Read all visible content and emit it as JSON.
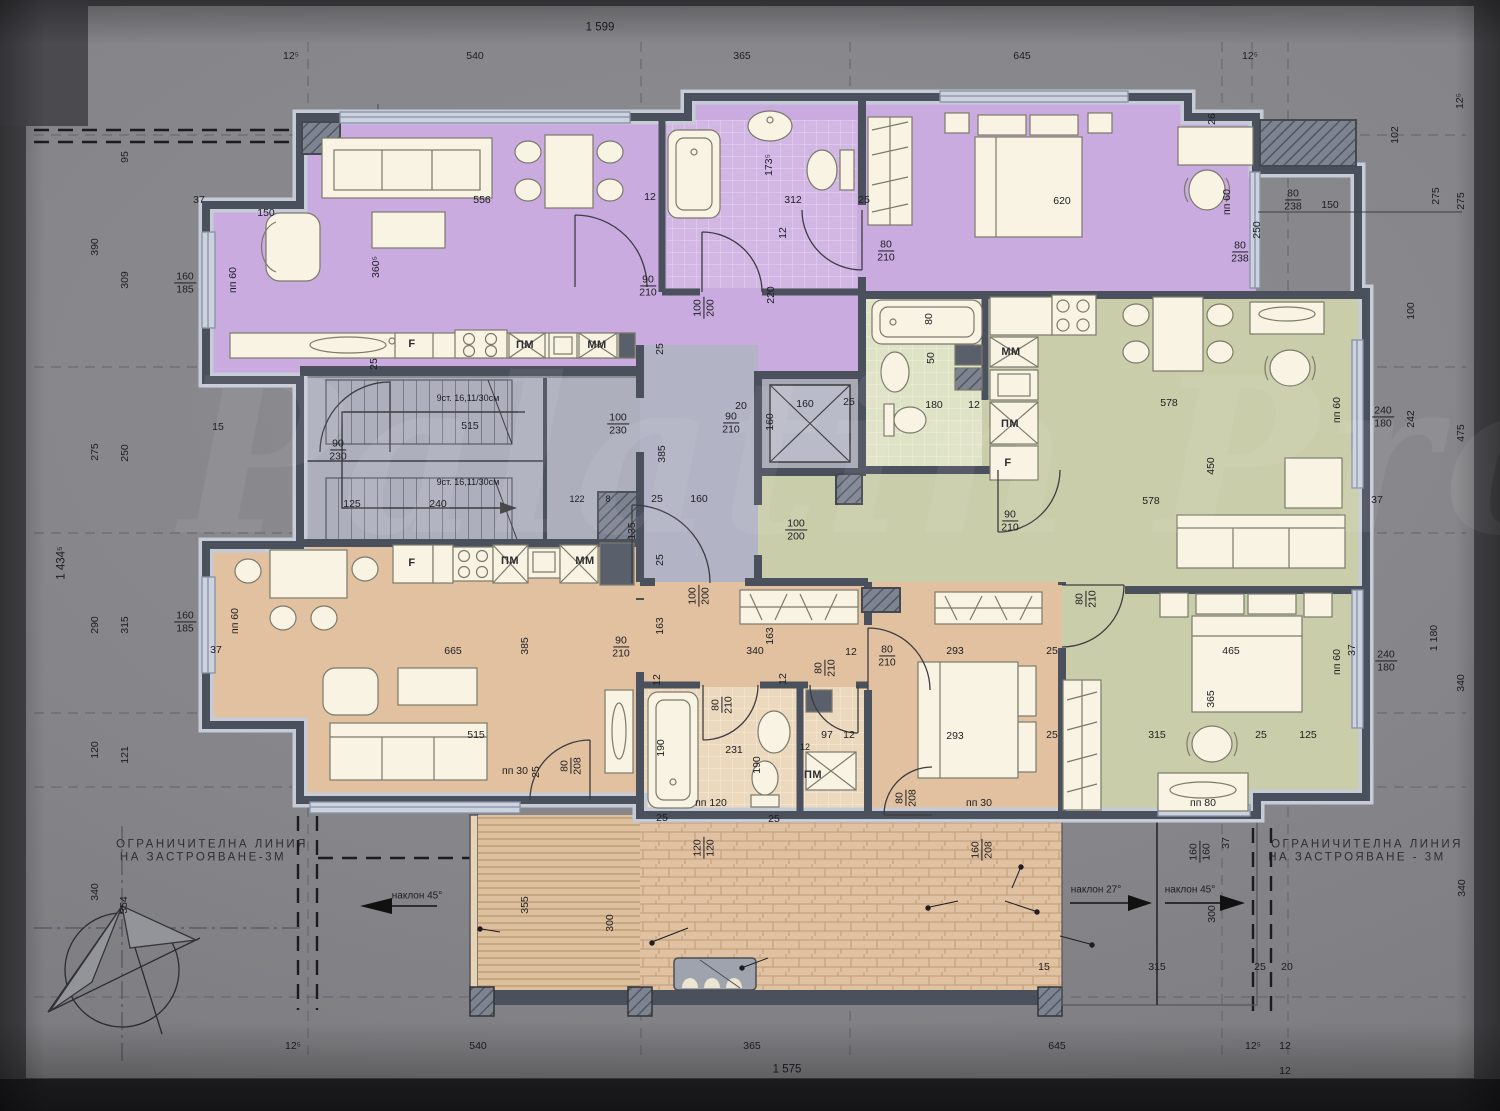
{
  "overall": {
    "top": "1 599",
    "bottom": "1 575",
    "left": "1 434⁵"
  },
  "apartments": [
    {
      "name": "Ап. 13",
      "area": "62,80м2",
      "color": "#c9abdf"
    },
    {
      "name": "Ап. 14",
      "area": "60,72м2",
      "color": "#c9cda9"
    },
    {
      "name": "Ап. 15",
      "area": "79,56м2",
      "color": "#e2c1a0"
    }
  ],
  "rooms": {
    "stair_area": "12,87 м2",
    "hall_area": "6,26 м2",
    "stair_note": "с.тр.",
    "elec_note": "ел."
  },
  "terrace": {
    "title": "покрив тераса",
    "area": "24,38 м²",
    "notes": {
      "pergola": "пергола-по детайл",
      "curb1": "ст.бет. борд - шир. 15см",
      "curb2": "височина 120см",
      "shaft1": "инсталационна",
      "shaft2": "шахта- борд ст. бет. 15см"
    }
  },
  "boundary": {
    "line1": "ОГРАНИЧИТЕЛНА  ЛИНИЯ",
    "line2": "НА ЗАСТРОЯВАНЕ-3М",
    "line2_right": "НА ЗАСТРОЯВАНЕ - 3М"
  },
  "slopes": {
    "s45": "наклон 45°",
    "s27": "наклон 27°"
  },
  "watermark": "Palatin Pro",
  "colors": {
    "wall": "#4b505d",
    "window": "#ccd3df",
    "deck": "#dcc09e",
    "brick": "#e0c2a2",
    "core_gray": "#aeafbd"
  },
  "dims": [
    {
      "t": "12⁵",
      "x": 291,
      "y": 57
    },
    {
      "t": "540",
      "x": 475,
      "y": 57
    },
    {
      "t": "365",
      "x": 742,
      "y": 57
    },
    {
      "t": "645",
      "x": 1022,
      "y": 57
    },
    {
      "t": "12⁵",
      "x": 1250,
      "y": 57
    },
    {
      "t": "12⁵",
      "x": 293,
      "y": 1047
    },
    {
      "t": "540",
      "x": 478,
      "y": 1047
    },
    {
      "t": "365",
      "x": 752,
      "y": 1047
    },
    {
      "t": "645",
      "x": 1057,
      "y": 1047
    },
    {
      "t": "12⁵",
      "x": 1253,
      "y": 1047
    },
    {
      "t": "12",
      "x": 1285,
      "y": 1047
    },
    {
      "t": "12",
      "x": 1285,
      "y": 1072
    },
    {
      "t": "390",
      "x": 96,
      "y": 247,
      "r": 1
    },
    {
      "t": "95",
      "x": 126,
      "y": 157,
      "r": 1
    },
    {
      "t": "309",
      "x": 126,
      "y": 280,
      "r": 1
    },
    {
      "t": "275",
      "x": 96,
      "y": 452,
      "r": 1
    },
    {
      "t": "250",
      "x": 126,
      "y": 453,
      "r": 1
    },
    {
      "t": "290",
      "x": 96,
      "y": 625,
      "r": 1
    },
    {
      "t": "315",
      "x": 126,
      "y": 625,
      "r": 1
    },
    {
      "t": "120",
      "x": 96,
      "y": 750,
      "r": 1
    },
    {
      "t": "121",
      "x": 126,
      "y": 755,
      "r": 1
    },
    {
      "t": "340",
      "x": 96,
      "y": 892,
      "r": 1
    },
    {
      "t": "354",
      "x": 125,
      "y": 905,
      "r": 1
    },
    {
      "t": "12⁵",
      "x": 1461,
      "y": 101,
      "r": 1
    },
    {
      "t": "102",
      "x": 1396,
      "y": 135,
      "r": 1
    },
    {
      "t": "275",
      "x": 1437,
      "y": 196,
      "r": 1
    },
    {
      "t": "275",
      "x": 1462,
      "y": 201,
      "r": 1
    },
    {
      "t": "100",
      "x": 1412,
      "y": 311,
      "r": 1
    },
    {
      "t": "242",
      "x": 1412,
      "y": 419,
      "r": 1
    },
    {
      "t": "475",
      "x": 1462,
      "y": 433,
      "r": 1
    },
    {
      "t": "1 180",
      "x": 1435,
      "y": 638,
      "r": 1
    },
    {
      "t": "340",
      "x": 1462,
      "y": 683,
      "r": 1
    },
    {
      "t": "340",
      "x": 1463,
      "y": 888,
      "r": 1
    },
    {
      "t": "37",
      "x": 1377,
      "y": 501
    },
    {
      "t": "37",
      "x": 1353,
      "y": 650,
      "r": 1
    },
    {
      "t": "160|185",
      "x": 185,
      "y": 283,
      "k": "f"
    },
    {
      "t": "160|185",
      "x": 185,
      "y": 622,
      "k": "f"
    },
    {
      "t": "240|180",
      "x": 1383,
      "y": 417,
      "k": "f"
    },
    {
      "t": "240|180",
      "x": 1386,
      "y": 661,
      "k": "f"
    },
    {
      "t": "80|238",
      "x": 1293,
      "y": 200,
      "k": "f"
    },
    {
      "t": "80|238",
      "x": 1240,
      "y": 252,
      "k": "f"
    },
    {
      "t": "80|210",
      "x": 886,
      "y": 251,
      "k": "f"
    },
    {
      "t": "90|210",
      "x": 731,
      "y": 423,
      "k": "f"
    },
    {
      "t": "90|210",
      "x": 648,
      "y": 286,
      "k": "f"
    },
    {
      "t": "90|210",
      "x": 1010,
      "y": 521,
      "k": "f"
    },
    {
      "t": "100|200",
      "x": 796,
      "y": 530,
      "k": "f"
    },
    {
      "t": "100|230",
      "x": 618,
      "y": 424,
      "k": "f"
    },
    {
      "t": "90|230",
      "x": 338,
      "y": 450,
      "k": "f"
    },
    {
      "t": "100|200",
      "x": 704,
      "y": 308,
      "k": "f",
      "r": 1
    },
    {
      "t": "80|210",
      "x": 1086,
      "y": 599,
      "k": "f",
      "r": 1
    },
    {
      "t": "80|210",
      "x": 825,
      "y": 668,
      "k": "f",
      "r": 1
    },
    {
      "t": "80|210",
      "x": 722,
      "y": 705,
      "k": "f",
      "r": 1
    },
    {
      "t": "100|200",
      "x": 699,
      "y": 596,
      "k": "f",
      "r": 1
    },
    {
      "t": "80|208",
      "x": 571,
      "y": 766,
      "k": "f",
      "r": 1
    },
    {
      "t": "80|208",
      "x": 906,
      "y": 798,
      "k": "f",
      "r": 1
    },
    {
      "t": "160|208",
      "x": 982,
      "y": 850,
      "k": "f",
      "r": 1
    },
    {
      "t": "120|120",
      "x": 704,
      "y": 848,
      "k": "f",
      "r": 1
    },
    {
      "t": "160|160",
      "x": 1200,
      "y": 852,
      "k": "f",
      "r": 1
    },
    {
      "t": "80|210",
      "x": 887,
      "y": 656,
      "k": "f"
    },
    {
      "t": "90|210",
      "x": 621,
      "y": 647,
      "k": "f"
    },
    {
      "t": "556",
      "x": 482,
      "y": 201
    },
    {
      "t": "150",
      "x": 266,
      "y": 214
    },
    {
      "t": "360⁵",
      "x": 377,
      "y": 267,
      "r": 1
    },
    {
      "t": "пп 60",
      "x": 234,
      "y": 280,
      "r": 1
    },
    {
      "t": "пп 60",
      "x": 236,
      "y": 621,
      "r": 1
    },
    {
      "t": "пп 60",
      "x": 1338,
      "y": 410,
      "r": 1
    },
    {
      "t": "пп 60",
      "x": 1338,
      "y": 662,
      "r": 1
    },
    {
      "t": "пп 60",
      "x": 1228,
      "y": 202,
      "r": 1
    },
    {
      "t": "250",
      "x": 1258,
      "y": 230,
      "r": 1
    },
    {
      "t": "150",
      "x": 1330,
      "y": 206
    },
    {
      "t": "26",
      "x": 1213,
      "y": 119,
      "r": 1
    },
    {
      "t": "пп 30",
      "x": 515,
      "y": 772
    },
    {
      "t": "пп 30",
      "x": 979,
      "y": 804
    },
    {
      "t": "пп 120",
      "x": 711,
      "y": 804
    },
    {
      "t": "пп 80",
      "x": 1203,
      "y": 804
    },
    {
      "t": "173⁵",
      "x": 770,
      "y": 165,
      "r": 1
    },
    {
      "t": "312",
      "x": 793,
      "y": 201
    },
    {
      "t": "25",
      "x": 864,
      "y": 201
    },
    {
      "t": "220",
      "x": 772,
      "y": 295,
      "r": 1
    },
    {
      "t": "620",
      "x": 1062,
      "y": 202
    },
    {
      "t": "12",
      "x": 650,
      "y": 198
    },
    {
      "t": "12",
      "x": 784,
      "y": 233,
      "r": 1
    },
    {
      "t": "25",
      "x": 375,
      "y": 364,
      "r": 1
    },
    {
      "t": "180",
      "x": 934,
      "y": 406
    },
    {
      "t": "12",
      "x": 974,
      "y": 406
    },
    {
      "t": "80",
      "x": 930,
      "y": 319,
      "r": 1
    },
    {
      "t": "50",
      "x": 932,
      "y": 358,
      "r": 1
    },
    {
      "t": "160",
      "x": 805,
      "y": 405
    },
    {
      "t": "25",
      "x": 849,
      "y": 403
    },
    {
      "t": "20",
      "x": 741,
      "y": 407
    },
    {
      "t": "160",
      "x": 771,
      "y": 422,
      "r": 1
    },
    {
      "t": "578",
      "x": 1169,
      "y": 404
    },
    {
      "t": "578",
      "x": 1151,
      "y": 502
    },
    {
      "t": "450",
      "x": 1212,
      "y": 466,
      "r": 1
    },
    {
      "t": "515",
      "x": 470,
      "y": 427
    },
    {
      "t": "125",
      "x": 352,
      "y": 505
    },
    {
      "t": "240",
      "x": 438,
      "y": 505
    },
    {
      "t": "15",
      "x": 218,
      "y": 428
    },
    {
      "t": "122",
      "x": 577,
      "y": 500,
      "k": "s"
    },
    {
      "t": "8",
      "x": 608,
      "y": 500,
      "k": "s"
    },
    {
      "t": "9ст. 16,11/30см",
      "x": 468,
      "y": 399,
      "k": "s"
    },
    {
      "t": "9ст. 16,11/30см",
      "x": 468,
      "y": 483,
      "k": "s"
    },
    {
      "t": "135",
      "x": 633,
      "y": 531,
      "r": 1
    },
    {
      "t": "160",
      "x": 699,
      "y": 500
    },
    {
      "t": "25",
      "x": 657,
      "y": 500
    },
    {
      "t": "385",
      "x": 663,
      "y": 454,
      "r": 1
    },
    {
      "t": "25",
      "x": 661,
      "y": 349,
      "r": 1
    },
    {
      "t": "25",
      "x": 661,
      "y": 560,
      "r": 1
    },
    {
      "t": "665",
      "x": 453,
      "y": 652
    },
    {
      "t": "385",
      "x": 526,
      "y": 646,
      "r": 1
    },
    {
      "t": "515",
      "x": 476,
      "y": 736
    },
    {
      "t": "37",
      "x": 199,
      "y": 201
    },
    {
      "t": "37",
      "x": 216,
      "y": 651
    },
    {
      "t": "163",
      "x": 661,
      "y": 626,
      "r": 1
    },
    {
      "t": "163",
      "x": 771,
      "y": 636,
      "r": 1
    },
    {
      "t": "340",
      "x": 755,
      "y": 652
    },
    {
      "t": "12",
      "x": 851,
      "y": 653
    },
    {
      "t": "293",
      "x": 955,
      "y": 652
    },
    {
      "t": "293",
      "x": 955,
      "y": 737
    },
    {
      "t": "25",
      "x": 1052,
      "y": 652
    },
    {
      "t": "25",
      "x": 1052,
      "y": 736
    },
    {
      "t": "12",
      "x": 658,
      "y": 680,
      "r": 1
    },
    {
      "t": "12",
      "x": 784,
      "y": 679,
      "r": 1
    },
    {
      "t": "231",
      "x": 734,
      "y": 751
    },
    {
      "t": "190",
      "x": 662,
      "y": 748,
      "r": 1
    },
    {
      "t": "190",
      "x": 758,
      "y": 765,
      "r": 1
    },
    {
      "t": "97",
      "x": 827,
      "y": 736
    },
    {
      "t": "12",
      "x": 849,
      "y": 736
    },
    {
      "t": "12",
      "x": 805,
      "y": 748,
      "k": "s"
    },
    {
      "t": "465",
      "x": 1231,
      "y": 652
    },
    {
      "t": "365",
      "x": 1212,
      "y": 699,
      "r": 1
    },
    {
      "t": "315",
      "x": 1157,
      "y": 736
    },
    {
      "t": "25",
      "x": 1261,
      "y": 736
    },
    {
      "t": "125",
      "x": 1308,
      "y": 736
    },
    {
      "t": "25",
      "x": 662,
      "y": 819
    },
    {
      "t": "25",
      "x": 774,
      "y": 820
    },
    {
      "t": "25",
      "x": 537,
      "y": 772,
      "r": 1
    },
    {
      "t": "355",
      "x": 526,
      "y": 905,
      "r": 1
    },
    {
      "t": "300",
      "x": 611,
      "y": 923,
      "r": 1
    },
    {
      "t": "300",
      "x": 1213,
      "y": 914,
      "r": 1
    },
    {
      "t": "315",
      "x": 1157,
      "y": 968
    },
    {
      "t": "25",
      "x": 1260,
      "y": 968
    },
    {
      "t": "20",
      "x": 1287,
      "y": 968
    },
    {
      "t": "15",
      "x": 1044,
      "y": 968
    },
    {
      "t": "37",
      "x": 1227,
      "y": 843,
      "r": 1
    },
    {
      "t": "ПМ",
      "x": 525,
      "y": 345,
      "k": "a"
    },
    {
      "t": "ММ",
      "x": 597,
      "y": 345,
      "k": "a"
    },
    {
      "t": "F",
      "x": 412,
      "y": 344,
      "k": "a"
    },
    {
      "t": "ММ",
      "x": 1011,
      "y": 352,
      "k": "a"
    },
    {
      "t": "ПМ",
      "x": 1010,
      "y": 424,
      "k": "a"
    },
    {
      "t": "F",
      "x": 1008,
      "y": 463,
      "k": "a"
    },
    {
      "t": "F",
      "x": 412,
      "y": 563,
      "k": "a"
    },
    {
      "t": "ПМ",
      "x": 510,
      "y": 561,
      "k": "a"
    },
    {
      "t": "ММ",
      "x": 585,
      "y": 561,
      "k": "a"
    },
    {
      "t": "ПМ",
      "x": 813,
      "y": 775,
      "k": "a"
    }
  ]
}
